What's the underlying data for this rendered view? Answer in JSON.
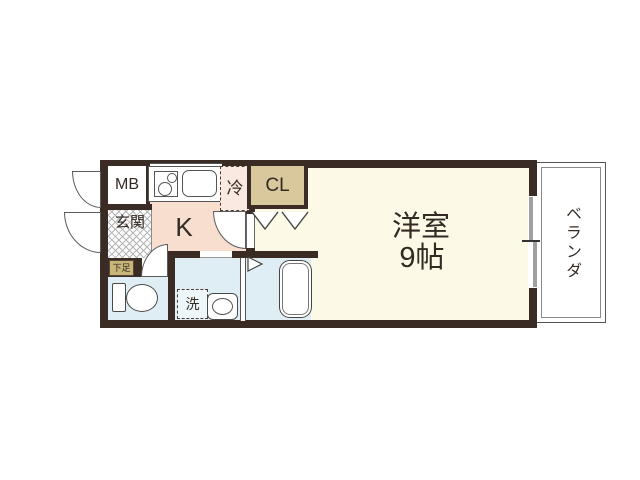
{
  "floorplan": {
    "title": "1K apartment floor plan",
    "labels": {
      "meter_box": "MB",
      "entrance": "玄関",
      "shoe_cabinet": "下足",
      "kitchen": "K",
      "refrigerator": "冷",
      "closet": "CL",
      "main_room": "洋室",
      "main_room_size": "9帖",
      "washing_machine": "洗",
      "veranda": "ベランダ"
    },
    "colors": {
      "wall": "#3a2c25",
      "kitchen_floor": "#f7decf",
      "main_room_floor": "#fcf9e7",
      "wet_area_floor": "#dfeef4",
      "closet_fill": "#d9c89c",
      "shoe_box_fill": "#c8b578",
      "refrigerator_fill": "#f9e9e1",
      "slider_gray": "#a0a0a0",
      "text": "#332a24"
    }
  }
}
